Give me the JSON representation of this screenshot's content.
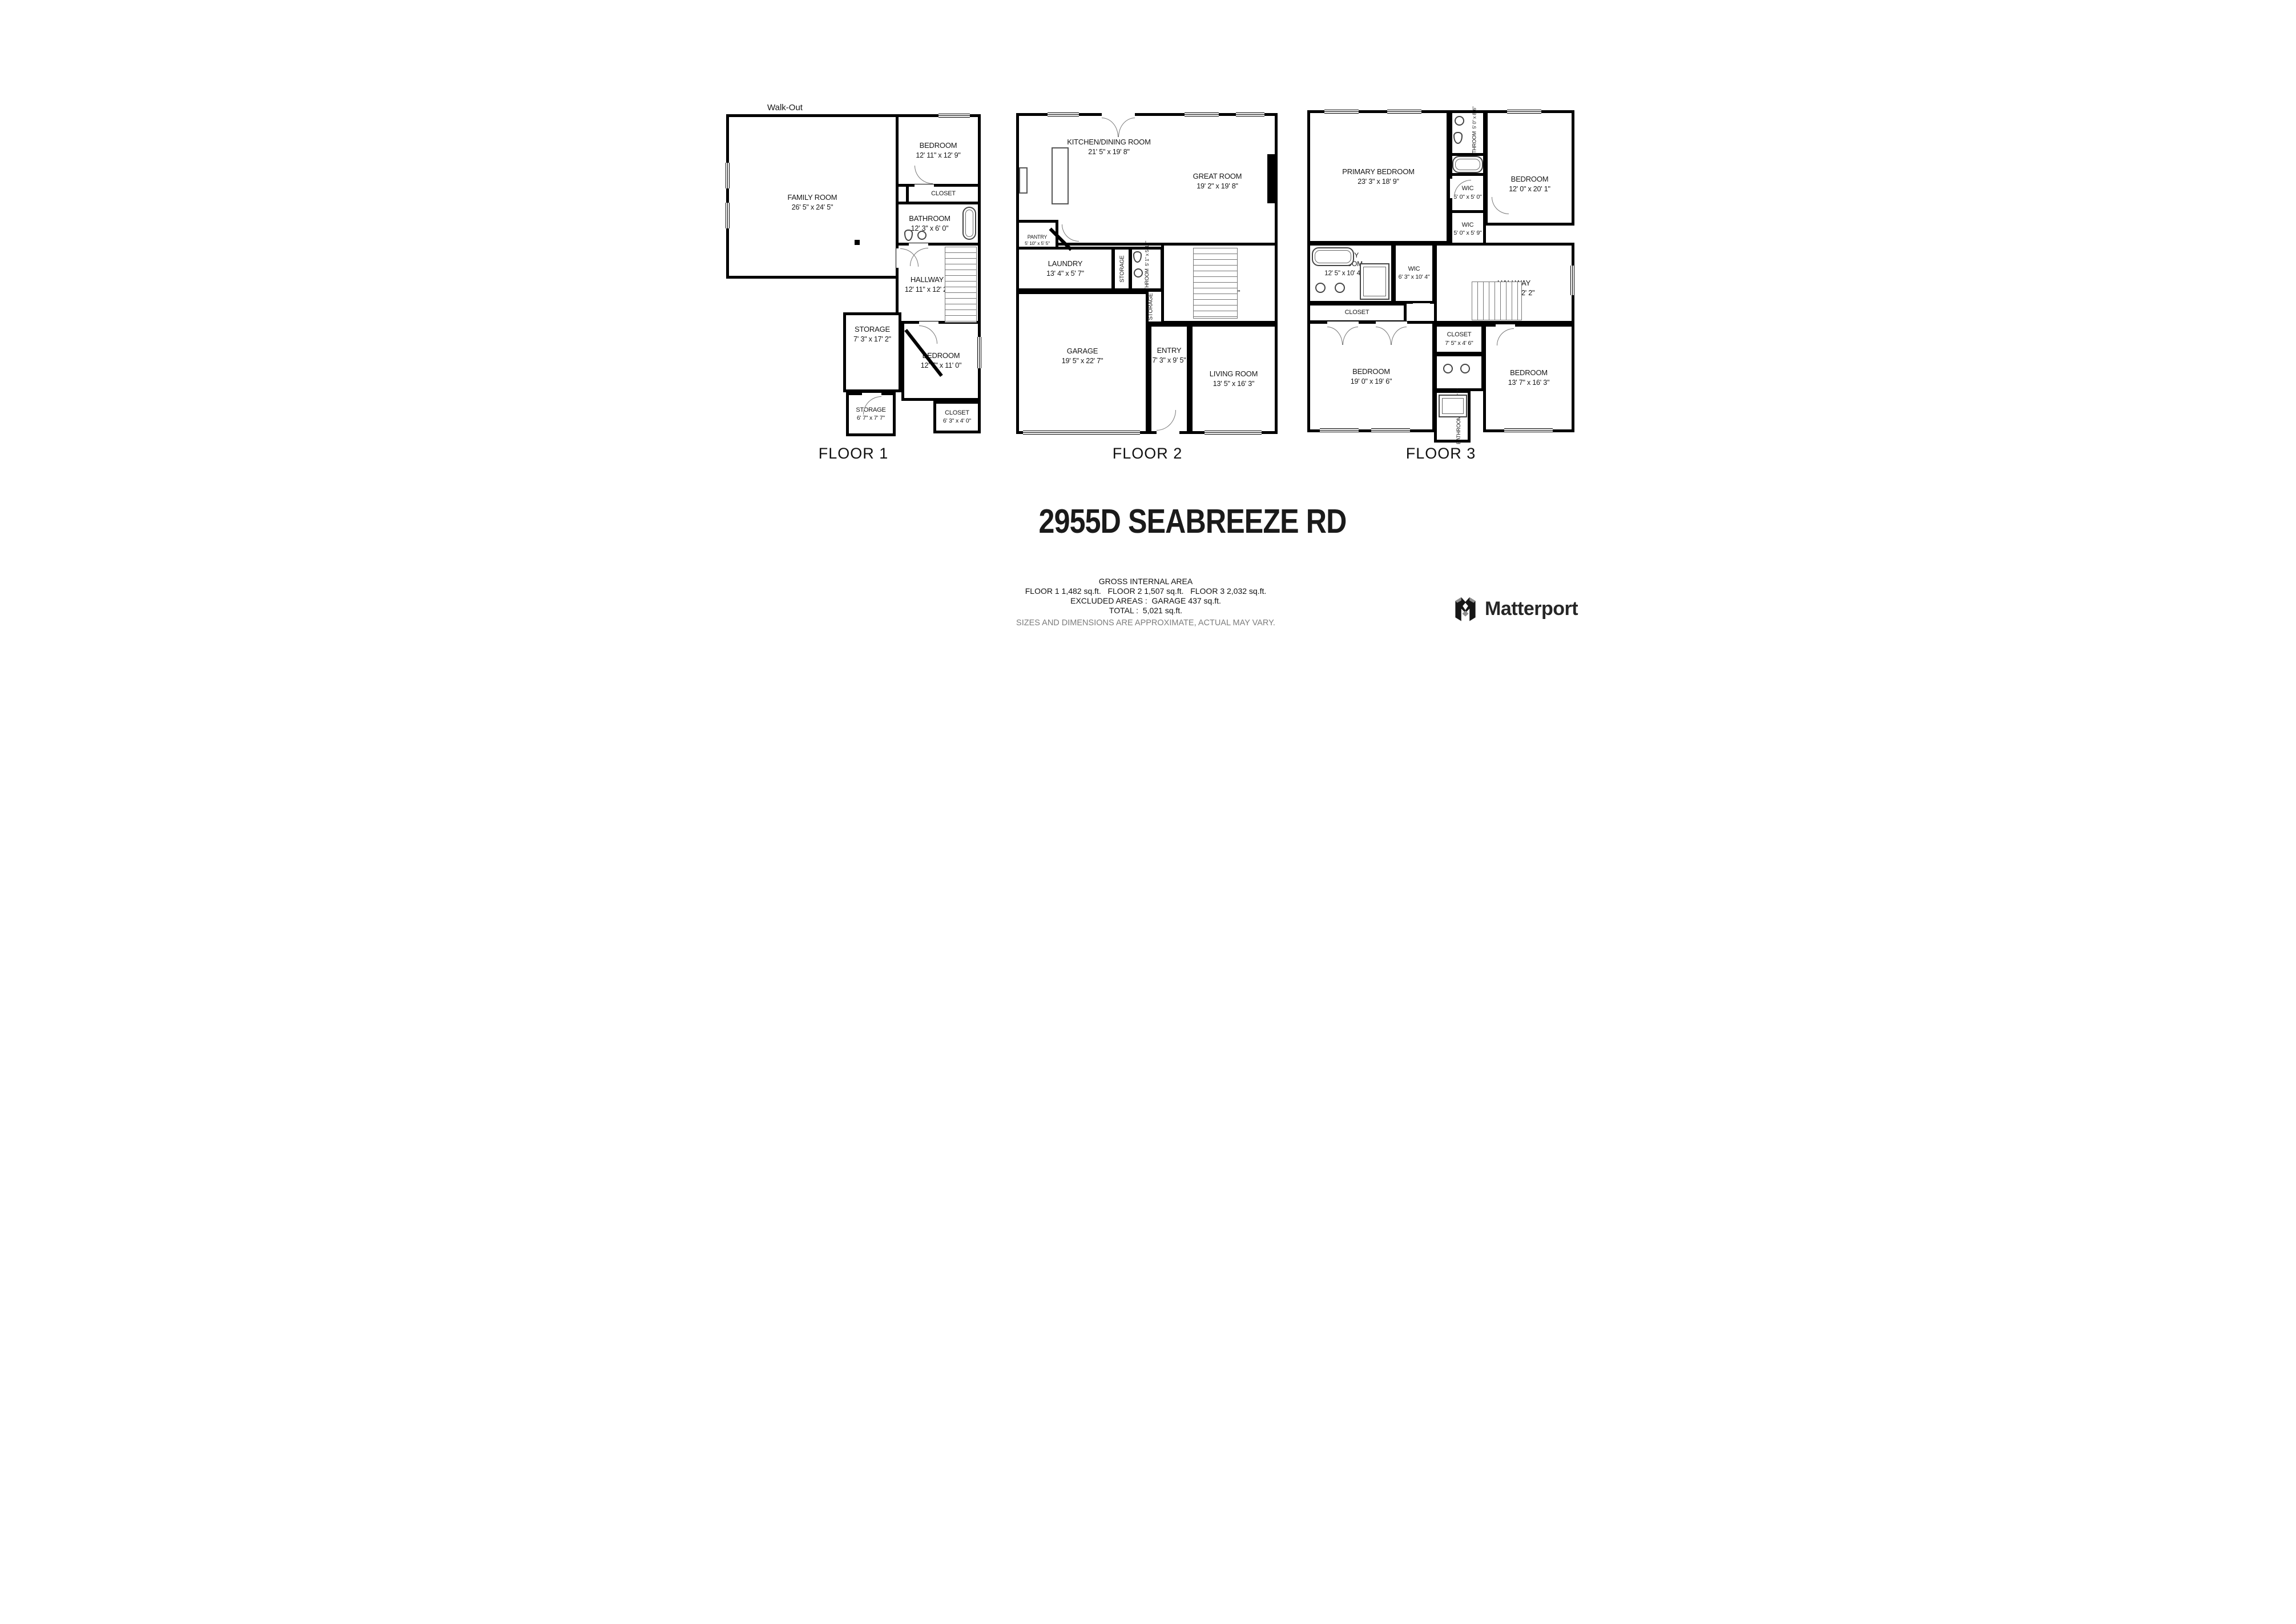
{
  "title": "2955D SEABREEZE RD",
  "floors": [
    {
      "label": "FLOOR 1",
      "annotation": "Walk-Out",
      "rooms": [
        {
          "name": "FAMILY ROOM",
          "dims": "26' 5\" x 24' 5\""
        },
        {
          "name": "BEDROOM",
          "dims": "12' 11\" x 12' 9\""
        },
        {
          "name": "CLOSET",
          "dims": ""
        },
        {
          "name": "BATHROOM",
          "dims": "12' 3\" x 6' 0\""
        },
        {
          "name": "HALLWAY",
          "dims": "12' 11\" x 12' 2\""
        },
        {
          "name": "STORAGE",
          "dims": "7' 3\" x 17' 2\""
        },
        {
          "name": "BEDROOM",
          "dims": "12' 7\" x 11' 0\""
        },
        {
          "name": "STORAGE",
          "dims": "6' 7\" x 7' 7\""
        },
        {
          "name": "CLOSET",
          "dims": "6' 3\" x 4' 0\""
        }
      ]
    },
    {
      "label": "FLOOR 2",
      "rooms": [
        {
          "name": "KITCHEN/DINING ROOM",
          "dims": "21' 5\" x 19' 8\""
        },
        {
          "name": "GREAT ROOM",
          "dims": "19' 2\" x 19' 8\""
        },
        {
          "name": "PANTRY",
          "dims": "5' 10\" x 5' 5\""
        },
        {
          "name": "LAUNDRY",
          "dims": "13' 4\" x 5' 7\""
        },
        {
          "name": "STORAGE",
          "dims": ""
        },
        {
          "name": "BATHROOM",
          "dims": "5' 1\" x 5' 10\""
        },
        {
          "name": "STORAGE",
          "dims": ""
        },
        {
          "name": "HALLWAY",
          "dims": "19' 2\" x 12' 2\""
        },
        {
          "name": "GARAGE",
          "dims": "19' 5\" x 22' 7\""
        },
        {
          "name": "ENTRY",
          "dims": "7' 3\" x 9' 5\""
        },
        {
          "name": "LIVING ROOM",
          "dims": "13' 5\" x 16' 3\""
        }
      ]
    },
    {
      "label": "FLOOR 3",
      "rooms": [
        {
          "name": "PRIMARY BEDROOM",
          "dims": "23' 3\" x 18' 9\""
        },
        {
          "name": "BATHROOM",
          "dims": "5' 0\" x 8' 6\""
        },
        {
          "name": "BEDROOM",
          "dims": "12' 0\" x 20' 1\""
        },
        {
          "name": "WIC",
          "dims": "5' 0\" x 5' 0\""
        },
        {
          "name": "WIC",
          "dims": "5' 0\" x 5' 9\""
        },
        {
          "name": "PRIMARY BATHROOM",
          "dims": "12' 5\" x 10' 4\""
        },
        {
          "name": "WIC",
          "dims": "6' 3\" x 10' 4\""
        },
        {
          "name": "HALLWAY",
          "dims": "21' 6\" x 12' 2\""
        },
        {
          "name": "CLOSET",
          "dims": ""
        },
        {
          "name": "BEDROOM",
          "dims": "19' 0\" x 19' 6\""
        },
        {
          "name": "CLOSET",
          "dims": "7' 5\" x 4' 6\""
        },
        {
          "name": "BEDROOM",
          "dims": "13' 7\" x 16' 3\""
        },
        {
          "name": "BATHROOM",
          "dims": "7' 5\" x 13' 7\""
        }
      ]
    }
  ],
  "area_summary": {
    "heading": "GROSS INTERNAL AREA",
    "floors_line": "FLOOR 1 1,482 sq.ft.   FLOOR 2 1,507 sq.ft.   FLOOR 3 2,032 sq.ft.",
    "excluded_line": "EXCLUDED AREAS :  GARAGE 437 sq.ft.",
    "total_line": "TOTAL :  5,021 sq.ft.",
    "disclaimer": "SIZES AND DIMENSIONS ARE APPROXIMATE, ACTUAL MAY VARY."
  },
  "branding": {
    "name": "Matterport"
  },
  "colors": {
    "wall": "#000000",
    "text": "#161616",
    "muted": "#7d7d7d"
  }
}
